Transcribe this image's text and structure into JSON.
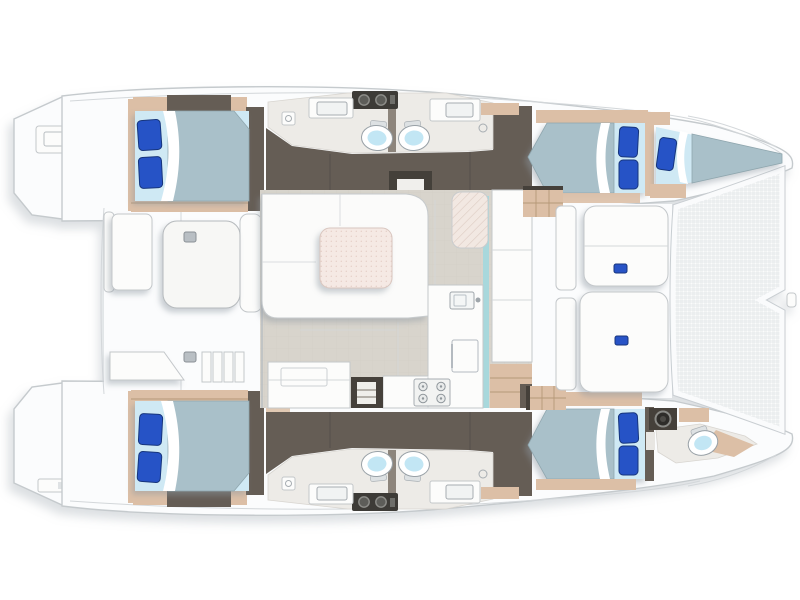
{
  "plan": {
    "description": "Top-down floor plan of a sailing catamaran: four double cabins with blue pillows, five bathrooms, central saloon with U-shaped settee, dining table and galley, aft cockpit with table, forward cockpit lounge pads and a bow trampoline net.",
    "vessel": "sailing catamaran",
    "view": "top-down accommodation and deck layout",
    "orientation": {
      "bow": "right",
      "stern": "left",
      "port_hull": "top",
      "starboard_hull": "bottom"
    },
    "areas": {
      "aft_cockpit": [
        "cockpit-table",
        "bench-seat",
        "aft-bench",
        "corner-seat",
        "side-steps",
        "deck-fittings"
      ],
      "saloon": [
        "u-shaped-settee",
        "dining-table",
        "chaise-seat",
        "galley-counter",
        "galley-sink",
        "refrigerator",
        "stove-4-burner",
        "aft-cabinet",
        "companionway-steps-port",
        "companionway-steps-starboard",
        "forward-cabin-steps"
      ],
      "forward_cockpit": [
        "lounge-pad-forward",
        "lounge-pad-aft",
        "storage-consoles",
        "cup-holders"
      ],
      "port_hull": [
        "aft-double-cabin",
        "aft-bathroom",
        "forward-bathroom",
        "forward-double-cabin",
        "bow-single-berth"
      ],
      "starboard_hull": [
        "aft-double-cabin",
        "aft-bathroom",
        "forward-bathroom",
        "forward-double-cabin",
        "bow-bathroom"
      ],
      "bow": [
        "trampoline-net",
        "bow-sprit"
      ],
      "stern": [
        "port-transom-steps",
        "starboard-transom-steps",
        "swim-platform"
      ]
    },
    "counts": {
      "double_beds": 4,
      "single_berths": 1,
      "toilets": 5,
      "sinks": 6,
      "shower-drains": 2,
      "stove_burners": 4
    }
  },
  "palette": {
    "hull_line": "#c5cacd",
    "deck_white": "#fbfcfd",
    "furniture_line": "#c3c7ca",
    "wood_trim": "#dcbfa6",
    "wood_line": "#b59878",
    "bulkhead_dark": "#655d55",
    "bulkhead_darker": "#45403a",
    "bed_sheet": "#cfe9f4",
    "bed_duvet": "#a9c0c9",
    "pillow_blue": "#2853c6",
    "pillow_edge": "#17357c",
    "toilet_bowl": "#c2e6f4",
    "saloon_floor": "#d8d4cc",
    "bath_floor": "#edebe7",
    "table_top": "#f5e9e4",
    "table_dot": "#e4cdc5",
    "chaise_fill": "#f2e8e2",
    "mesh_line": "#e1e4e7",
    "aqua_accent": "#a8d8dc",
    "fixture_dark": "#3d3b37",
    "shadow": "#8d98a1"
  }
}
